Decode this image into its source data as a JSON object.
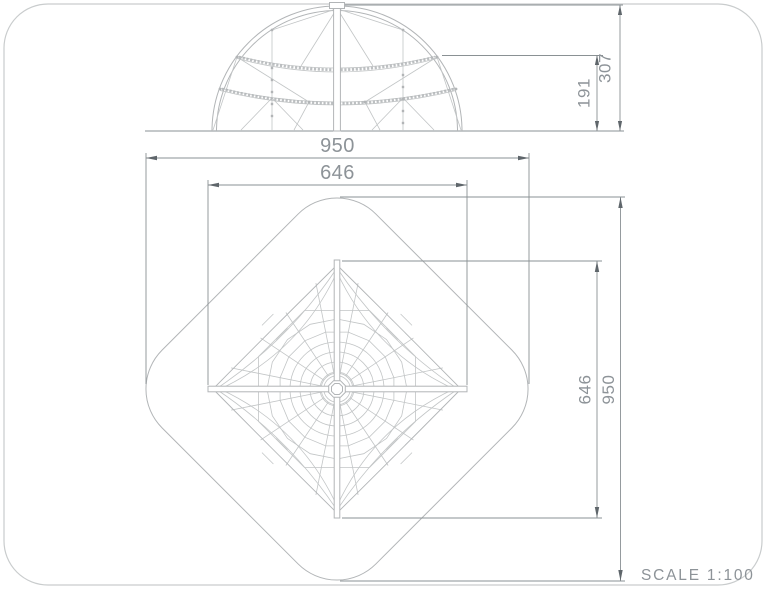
{
  "drawing": {
    "scale_label": "SCALE 1:100",
    "elevation": {
      "dims": {
        "net_height": "191",
        "total_height": "307"
      }
    },
    "plan": {
      "dims": {
        "outer_width": "950",
        "inner_width": "646",
        "inner_depth": "646",
        "outer_depth": "950"
      }
    },
    "colors": {
      "line": "#b2b5b7",
      "web": "#c2c5c6",
      "dimension": "#8a9194",
      "arrow": "#5f666b",
      "text": "#8d9398",
      "border": "#c9cccd"
    }
  }
}
